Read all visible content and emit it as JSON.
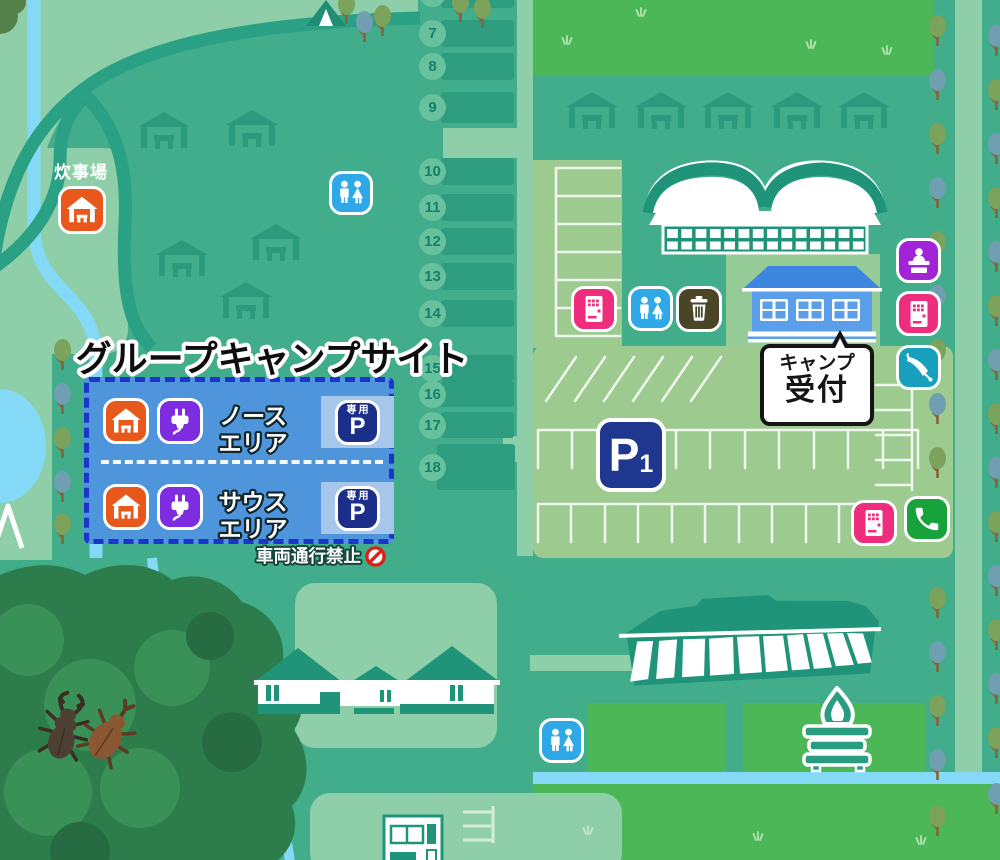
{
  "title": "グループキャンプサイト",
  "group_site": {
    "north_area": {
      "line1": "ノース",
      "line2": "エリア"
    },
    "south_area": {
      "line1": "サウス",
      "line2": "エリア"
    },
    "reserved_parking_label": "専用",
    "reserved_parking_p": "P"
  },
  "labels": {
    "cooking_area": "炊事場",
    "no_vehicles": "車両通行禁止"
  },
  "reception": {
    "line1": "キャンプ",
    "line2": "受付"
  },
  "parking": {
    "p": "P",
    "number": "1"
  },
  "sites": {
    "upper": [
      "7",
      "8",
      "9"
    ],
    "lower": [
      "10",
      "11",
      "12",
      "13",
      "14",
      "15",
      "16",
      "17",
      "18"
    ]
  },
  "icons": {
    "cooking_shelter": {
      "name": "cooking-shelter-icon",
      "color": "#e8581c"
    },
    "power_outlet": {
      "name": "power-plug-icon",
      "color": "#7d2ce0"
    },
    "toilet": {
      "name": "toilet-icon",
      "color": "#2fa8e8"
    },
    "vending_machine": {
      "name": "vending-machine-icon",
      "color": "#ee2d7d"
    },
    "trash": {
      "name": "trash-icon",
      "color": "#4a4527"
    },
    "reception_desk": {
      "name": "reception-desk-icon",
      "color": "#a224d8"
    },
    "umbrella_rental": {
      "name": "umbrella-icon",
      "color": "#16a0bb"
    },
    "phone": {
      "name": "phone-icon",
      "color": "#17a23b"
    },
    "no_entry": {
      "name": "no-entry-icon",
      "color": "#e02018"
    },
    "reserved_parking": {
      "name": "reserved-parking-icon",
      "color": "#1b2f8a"
    },
    "parking_p1": {
      "name": "parking-p1-sign",
      "color": "#20378f"
    },
    "campfire": {
      "name": "campfire-icon",
      "color": "#2a9d80"
    }
  },
  "colors": {
    "base_green": "#41ad8a",
    "mint": "#8ecfa9",
    "bright_field": "#4bb757",
    "parking_lot": "#9cca8f",
    "water": "#84daf6",
    "road_dark": "#2aa184",
    "forest": "#2d7c4c",
    "site_box_blue": "#4e95db",
    "site_box_dash": "#1d35cc"
  }
}
